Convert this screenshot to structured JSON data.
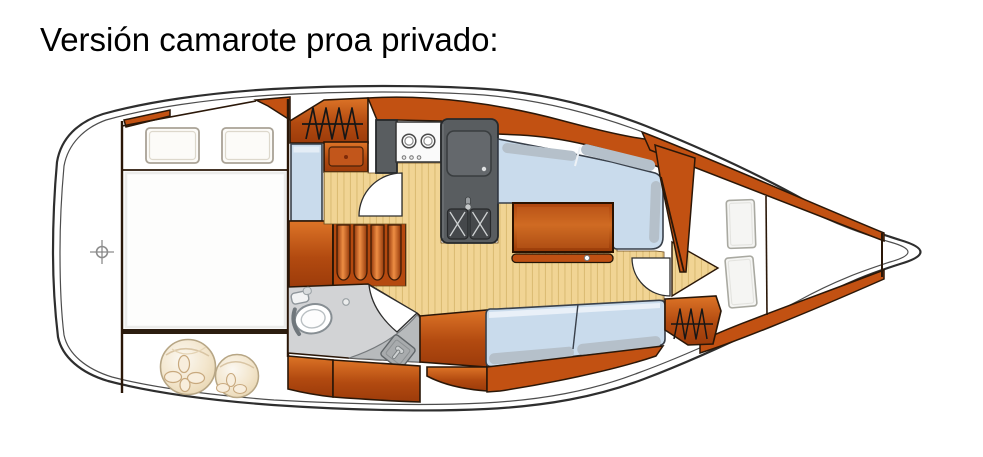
{
  "title": "Versión camarote proa privado:",
  "diagram_type": "sailboat-interior-floorplan-top-view",
  "colors": {
    "title_color": "#000000",
    "wood_orange": "#c25112",
    "wood_orange_dark": "#9c3b0a",
    "wood_orange_light": "#e2823c",
    "floor_tan": "#f1d494",
    "floor_stripe": "#dcbc74",
    "cushion_blue": "#c9dbec",
    "cushion_bevel": "#b5c0ca",
    "counter_gray": "#595d60",
    "sink_gray": "#45484b",
    "head_gray": "#d2d3d5",
    "shower_gray": "#b7babc",
    "hull_outline": "#2e2e2e",
    "furniture_outline": "#2a1708"
  },
  "icons": {
    "stern_marker": "crosshair-target-icon",
    "aft_wardrobe": "hanging-clothes-icon",
    "fwd_wardrobe": "hanging-clothes-icon",
    "galley": [
      "stove-two-burners-icon",
      "double-sink-icon",
      "sink-cover-icon",
      "faucet-icon"
    ],
    "head": [
      "toilet-icon",
      "shower-grate-icon",
      "drain-icon"
    ],
    "doors": [
      "door-swing-arc",
      "door-swing-arc",
      "door-swing-arc"
    ]
  }
}
